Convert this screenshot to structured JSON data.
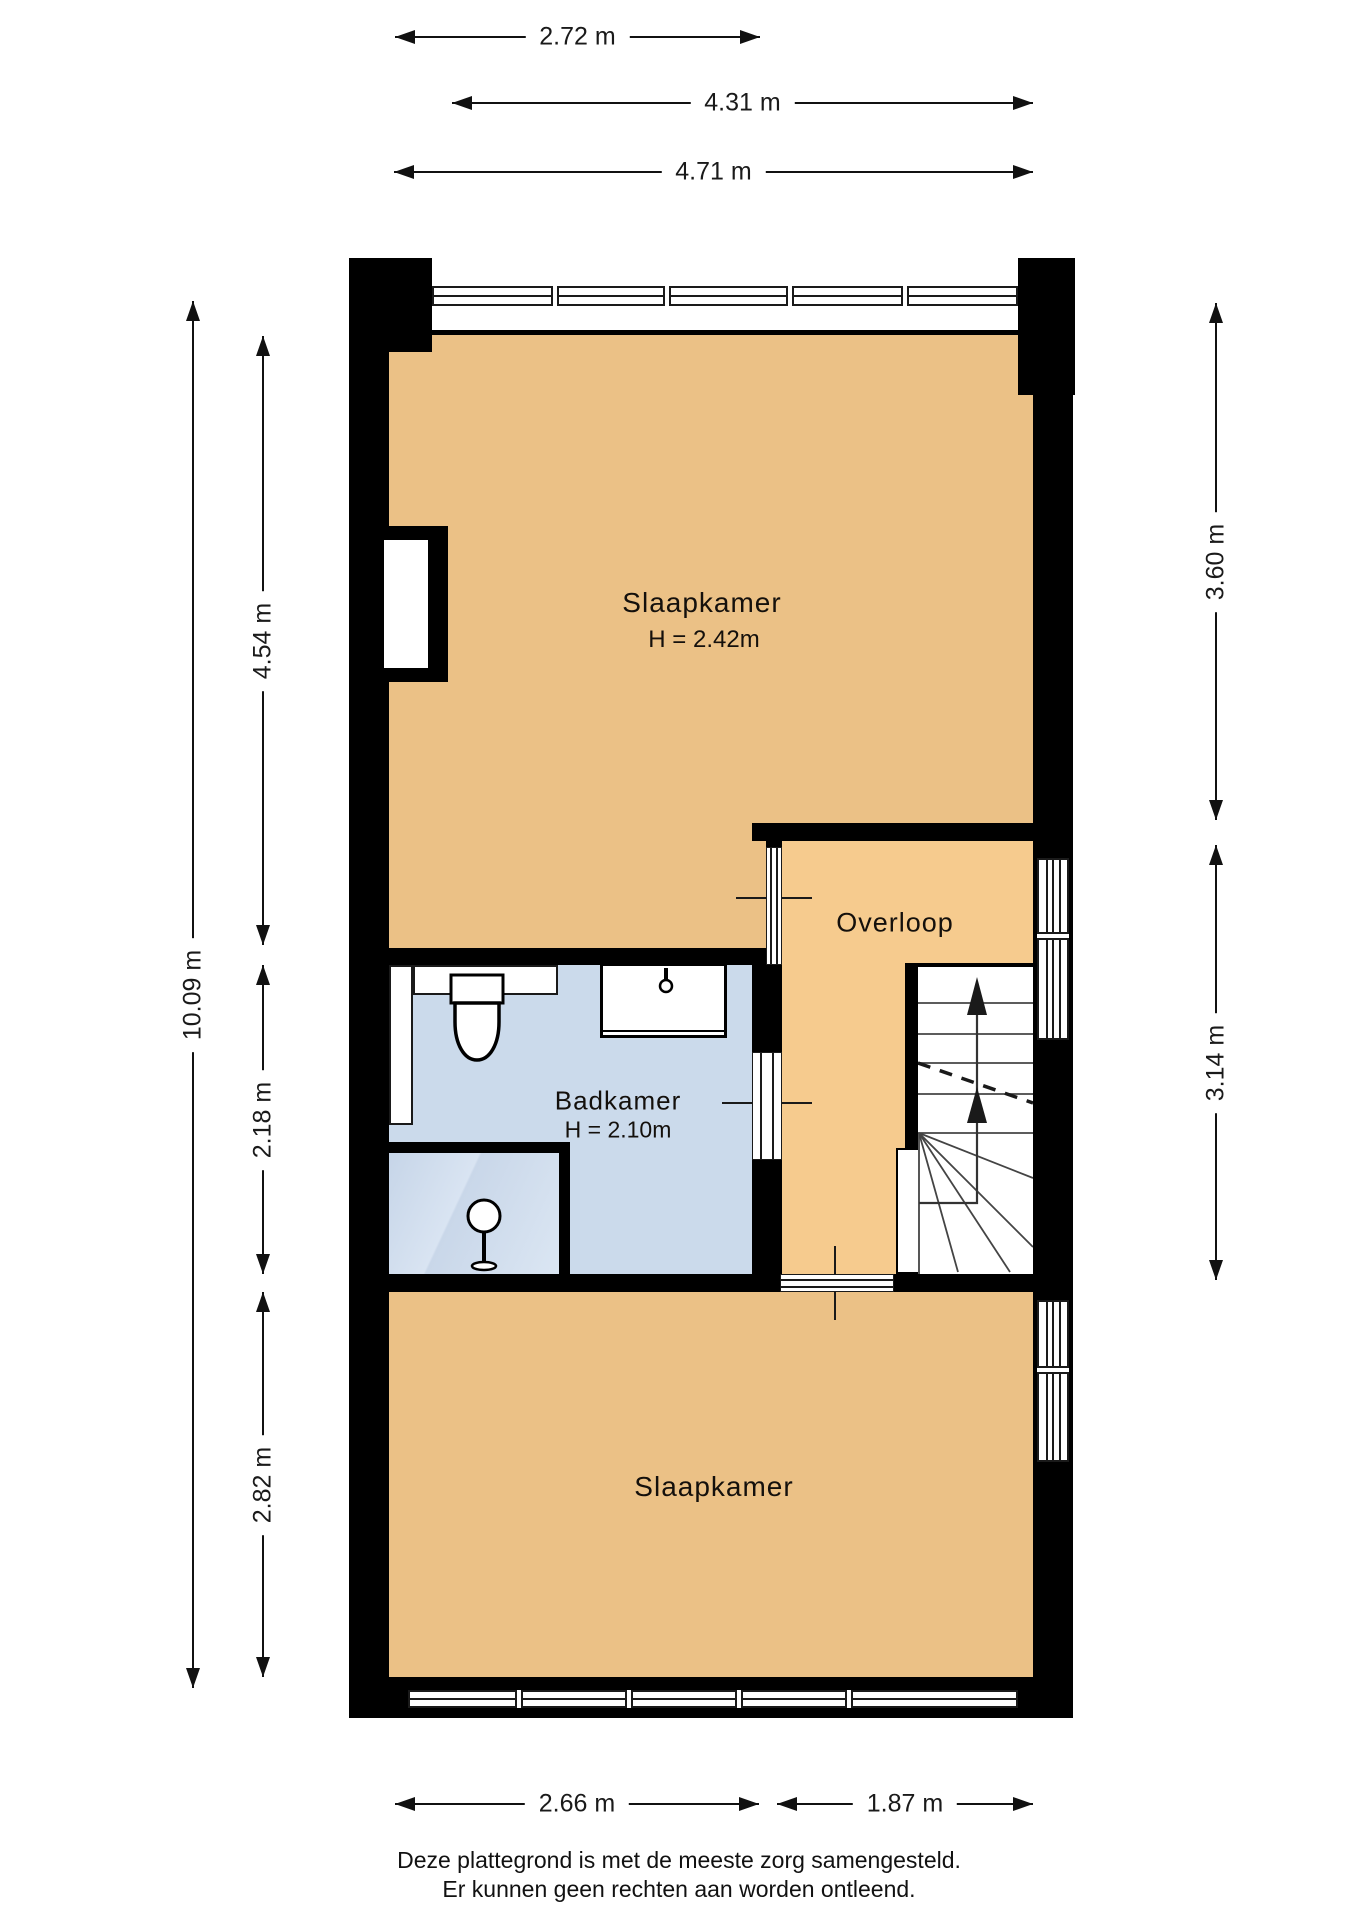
{
  "plan": {
    "rooms": {
      "bedroom_top": {
        "label": "Slaapkamer",
        "height": "H = 2.42m"
      },
      "bathroom": {
        "label": "Badkamer",
        "height": "H = 2.10m"
      },
      "landing": {
        "label": "Overloop"
      },
      "bedroom_bottom": {
        "label": "Slaapkamer"
      }
    },
    "dimensions": {
      "top": [
        {
          "label": "2.72 m"
        },
        {
          "label": "4.31 m"
        },
        {
          "label": "4.71 m"
        }
      ],
      "left_total": {
        "label": "10.09 m"
      },
      "left_segments": [
        {
          "label": "4.54 m"
        },
        {
          "label": "2.18 m"
        },
        {
          "label": "2.82 m"
        }
      ],
      "right": [
        {
          "label": "3.60 m"
        },
        {
          "label": "3.14 m"
        }
      ],
      "bottom": [
        {
          "label": "2.66 m"
        },
        {
          "label": "1.87 m"
        }
      ]
    },
    "disclaimer": {
      "line1": "Deze plattegrond is met de meeste zorg samengesteld.",
      "line2": "Er kunnen geen rechten aan worden ontleend."
    },
    "colors": {
      "wall": "#000000",
      "bedroom_floor": "#EBC186",
      "landing_floor": "#F6CB8E",
      "bathroom_floor": "#CBDAEB",
      "dimension_text": "#111111"
    },
    "icons": {
      "stair_direction": "arrow-up",
      "fixtures": [
        "toilet-icon",
        "sink-icon",
        "faucet-icon",
        "shower-drain-icon"
      ]
    }
  }
}
